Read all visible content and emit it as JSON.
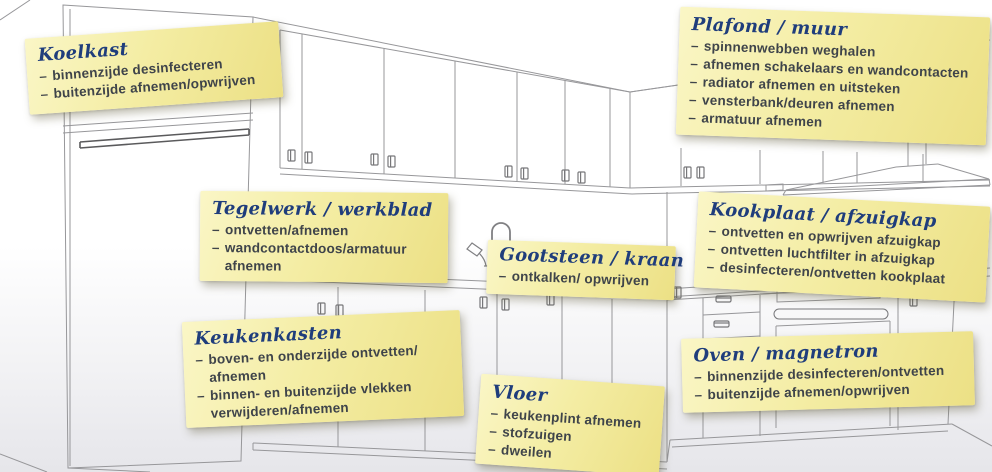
{
  "list_dash": "–",
  "colors": {
    "note_yellow": "#f4eda4",
    "note_yellow_edge": "#ece085",
    "title_blue": "#1f3d7c",
    "body_text": "#3f444a",
    "drawing_line": "#97979a"
  },
  "notes": [
    {
      "id": "koelkast",
      "title": "Koelkast",
      "items": [
        "binnenzijde desinfecteren",
        "buitenzijde afnemen/opwrijven"
      ]
    },
    {
      "id": "plafond-muur",
      "title": "Plafond / muur",
      "items": [
        "spinnenwebben weghalen",
        "afnemen schakelaars en wandcontacten",
        "radiator afnemen en uitsteken",
        "vensterbank/deuren afnemen",
        "armatuur afnemen"
      ]
    },
    {
      "id": "tegelwerk-werkblad",
      "title": "Tegelwerk / werkblad",
      "items": [
        "ontvetten/afnemen",
        "wandcontactdoos/armatuur afnemen"
      ]
    },
    {
      "id": "gootsteen-kraan",
      "title": "Gootsteen / kraan",
      "items": [
        "ontkalken/ opwrijven"
      ]
    },
    {
      "id": "kookplaat-afzuigkap",
      "title": "Kookplaat / afzuigkap",
      "items": [
        "ontvetten en opwrijven afzuigkap",
        "ontvetten luchtfilter in afzuigkap",
        "desinfecteren/ontvetten kookplaat"
      ]
    },
    {
      "id": "keukenkasten",
      "title": "Keukenkasten",
      "items": [
        "boven- en onderzijde ontvetten/ afnemen",
        "binnen- en buitenzijde vlekken verwijderen/afnemen"
      ]
    },
    {
      "id": "vloer",
      "title": "Vloer",
      "items": [
        "keukenplint afnemen",
        "stofzuigen",
        "dweilen"
      ]
    },
    {
      "id": "oven-magnetron",
      "title": "Oven / magnetron",
      "items": [
        "binnenzijde desinfecteren/ontvetten",
        "buitenzijde afnemen/opwrijven"
      ]
    }
  ]
}
